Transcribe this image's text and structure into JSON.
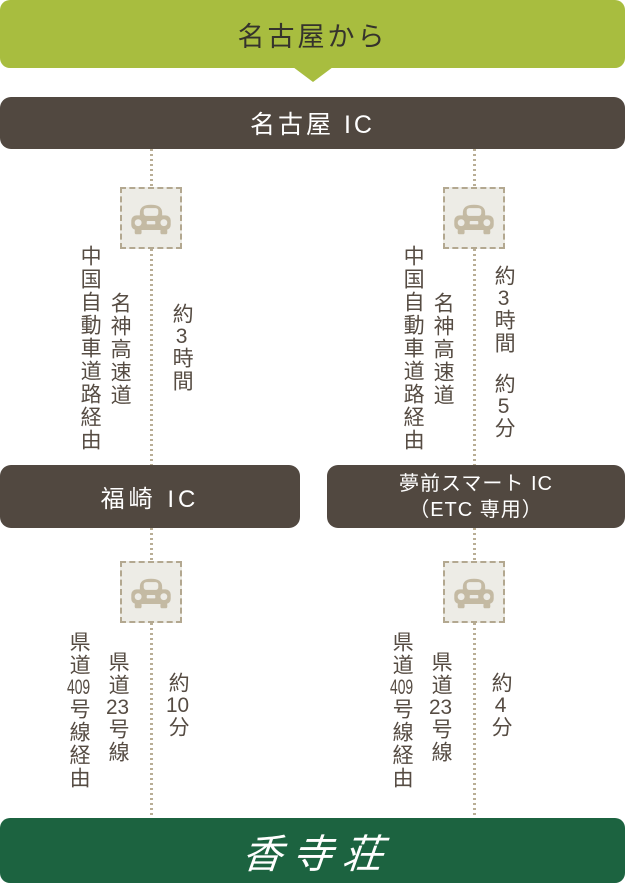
{
  "header": {
    "title": "名古屋から"
  },
  "start": {
    "label": "名古屋 IC"
  },
  "destination": {
    "logo_text": "香寺荘"
  },
  "colors": {
    "header_green": "#a8bd3f",
    "bar_brown": "#514840",
    "footer_green": "#1c6340",
    "line_tan": "#b9ae96",
    "icon_bg": "#edece6",
    "car_tan": "#c4baa3",
    "text_brown": "#564c43"
  },
  "routes": [
    {
      "id": "left",
      "leg1": {
        "via_detail": "中国自動車道路経由",
        "via_road": "名神高速道",
        "duration": {
          "seg1": "約",
          "num1": "3",
          "seg2": "時間"
        }
      },
      "waypoint": {
        "line1": "福崎 IC"
      },
      "leg2": {
        "via_detail": {
          "pre": "県道",
          "num": "409",
          "post": "号線経由"
        },
        "via_road": {
          "pre": "県道",
          "num": "23",
          "post": "号線"
        },
        "duration": {
          "seg1": "約",
          "num1": "10",
          "seg2": "分"
        }
      }
    },
    {
      "id": "right",
      "leg1": {
        "via_detail": "中国自動車道路経由",
        "via_road": "名神高速道",
        "duration": {
          "seg1": "約",
          "num1": "3",
          "seg2": "時間",
          "seg3": "約",
          "num2": "5",
          "seg4": "分"
        }
      },
      "waypoint": {
        "line1": "夢前スマート IC",
        "line2": "（ETC 専用）"
      },
      "leg2": {
        "via_detail": {
          "pre": "県道",
          "num": "409",
          "post": "号線経由"
        },
        "via_road": {
          "pre": "県道",
          "num": "23",
          "post": "号線"
        },
        "duration": {
          "seg1": "約",
          "num1": "4",
          "seg2": "分"
        }
      }
    }
  ]
}
